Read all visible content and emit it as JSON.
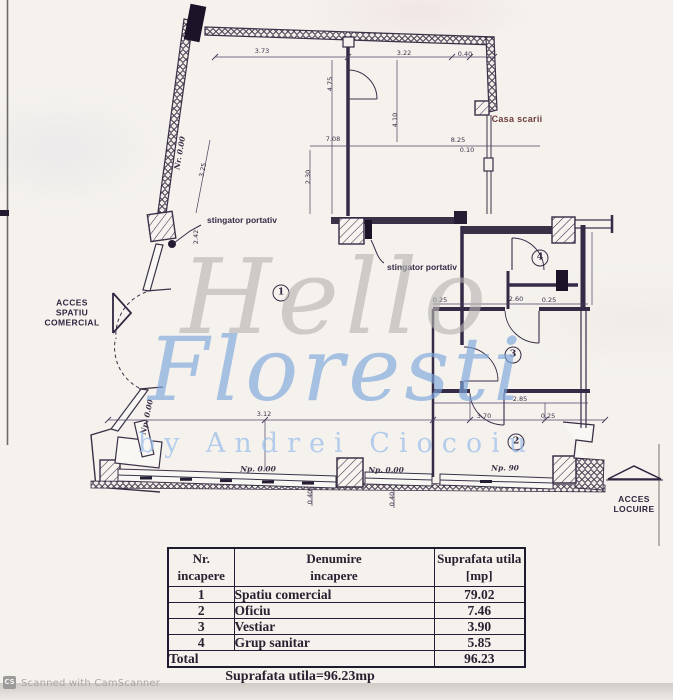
{
  "watermark": {
    "line1": "Hello",
    "line2": "Floresti",
    "line3": "by Andrei Ciocoiu",
    "gray": "#b5b3b0",
    "blue": "#7ea7dd",
    "light_blue": "#9fc0ea"
  },
  "plan": {
    "labels": {
      "casa_scarii": "Casa scarii",
      "stingator_left": "stingator portativ",
      "stingator_right": "stingator portativ",
      "acces_spatiu_line1": "ACCES",
      "acces_spatiu_line2": "SPATIU",
      "acces_spatiu_line3": "COMERCIAL",
      "acces_locuire_line1": "ACCES",
      "acces_locuire_line2": "LOCUIRE"
    },
    "rooms": {
      "r1": "1",
      "r2": "2",
      "r3": "3",
      "r4": "4"
    },
    "ink_color": "#3b3147",
    "dimensions": [
      {
        "text": "3.73"
      },
      {
        "text": "3.22"
      },
      {
        "text": "0.40"
      },
      {
        "text": "4.75"
      },
      {
        "text": "4.10"
      },
      {
        "text": "7.08"
      },
      {
        "text": "8.25"
      },
      {
        "text": "0.10"
      },
      {
        "text": "2.30"
      },
      {
        "text": "3.25"
      },
      {
        "text": "Nr. 0.00"
      },
      {
        "text": "2.42"
      },
      {
        "text": "0.25"
      },
      {
        "text": "2.60"
      },
      {
        "text": "0.25"
      },
      {
        "text": "2.85"
      },
      {
        "text": "3.70"
      },
      {
        "text": "0.25"
      },
      {
        "text": "3.12"
      },
      {
        "text": "Np. 0.00"
      },
      {
        "text": "Np. 0.00"
      },
      {
        "text": "Np. 90"
      },
      {
        "text": "Np. 0.00"
      },
      {
        "text": "0.40"
      },
      {
        "text": "0.40"
      }
    ]
  },
  "table": {
    "headers": [
      {
        "l1": "Nr.",
        "l2": "incapere"
      },
      {
        "l1": "Denumire",
        "l2": "incapere"
      },
      {
        "l1": "Suprafata utila",
        "l2": "[mp]"
      }
    ],
    "rows": [
      {
        "nr": "1",
        "name": "Spatiu comercial",
        "area": "79.02"
      },
      {
        "nr": "2",
        "name": "Oficiu",
        "area": "7.46"
      },
      {
        "nr": "3",
        "name": "Vestiar",
        "area": "3.90"
      },
      {
        "nr": "4",
        "name": "Grup sanitar",
        "area": "5.85"
      }
    ],
    "total_label": "Total",
    "total_value": "96.23",
    "footer": "Suprafata utila=96.23mp"
  },
  "scanner": {
    "badge": "CS",
    "text": "Scanned with CamScanner"
  }
}
